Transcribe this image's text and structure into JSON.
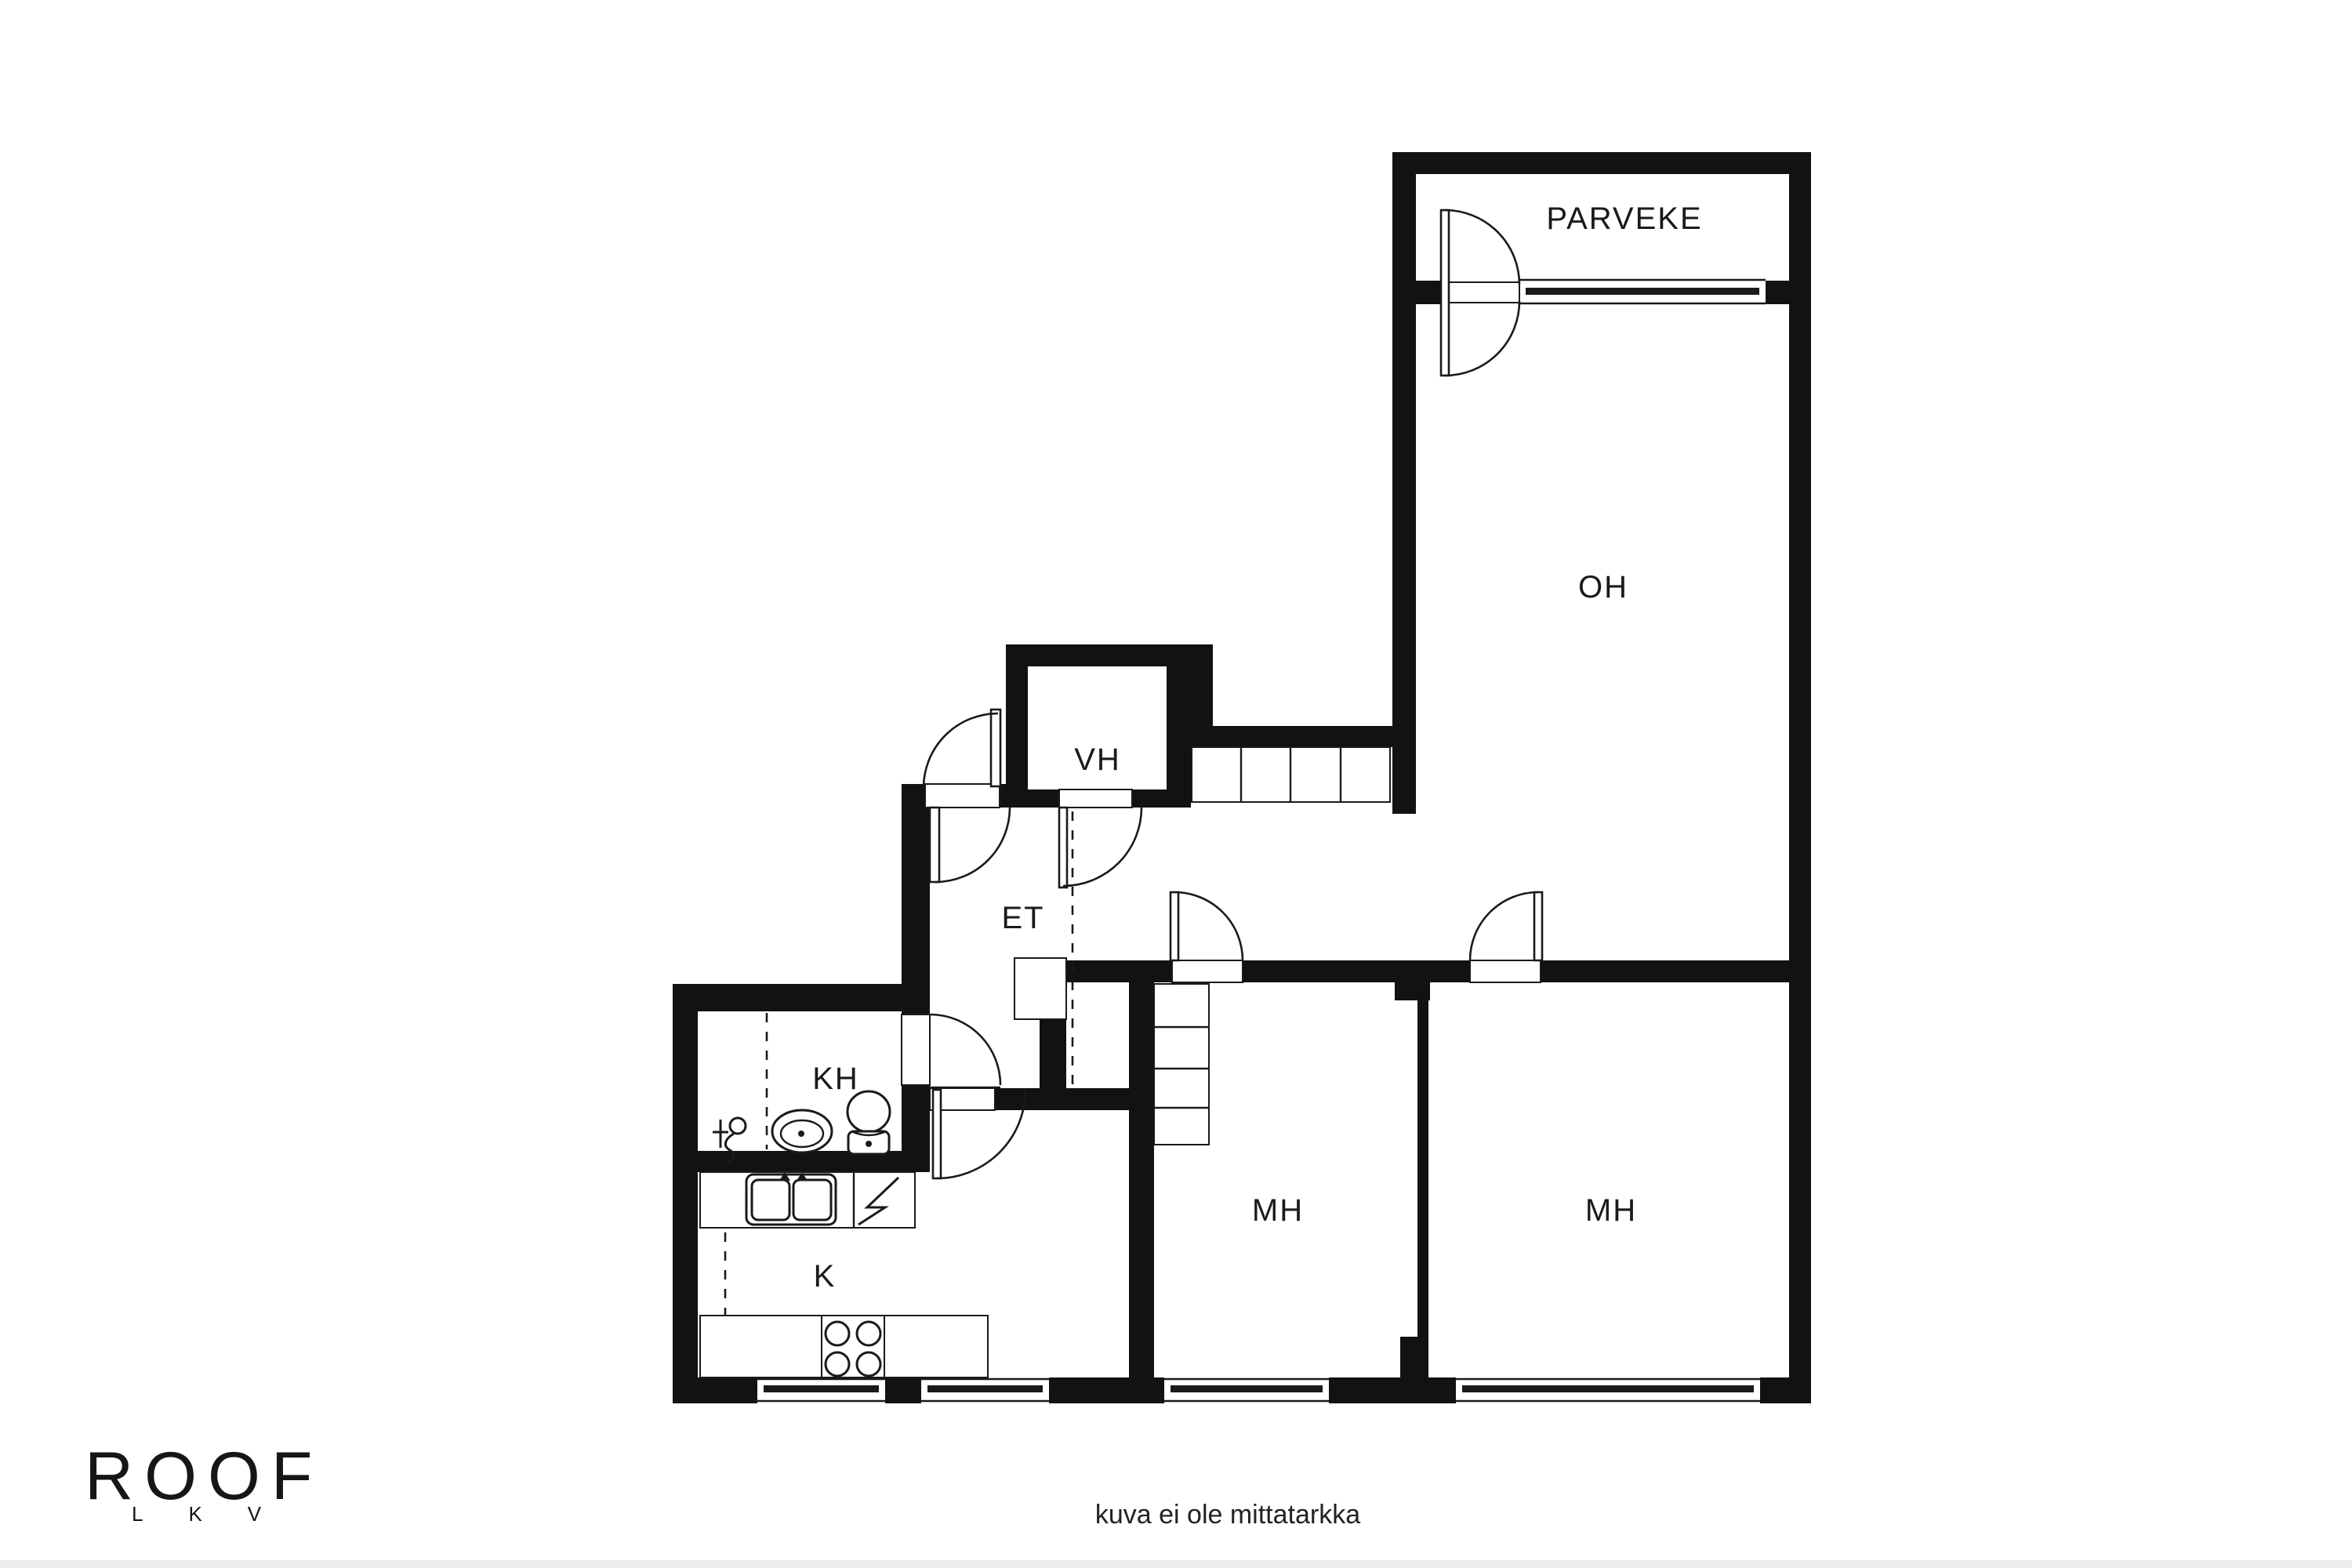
{
  "plan": {
    "type": "apartment-floor-plan",
    "rooms": {
      "balcony": "PARVEKE",
      "living_room": "OH",
      "wardrobe": "VH",
      "entry_hall": "ET",
      "bathroom": "KH",
      "kitchen": "K",
      "bedroom_left": "MH",
      "bedroom_right": "MH"
    }
  },
  "branding": {
    "logo_text": "ROOF",
    "logo_letters": "LKV"
  },
  "footer": {
    "disclaimer": "kuva ei ole mittatarkka"
  },
  "icons": {
    "door": "quarter-circle swing arc with leaf",
    "window": "double line with thick center bar",
    "wardrobe": "rectangle divided into cells",
    "toilet": "bowl with tank",
    "sink": "oval basin with dot",
    "shower": "drain circle with hose and cross",
    "stove": "square with four burner circles",
    "appliance": "square with lightning bolt"
  },
  "colors": {
    "ink": "#121212",
    "background": "#ffffff",
    "footer_strip": "#ececec"
  }
}
